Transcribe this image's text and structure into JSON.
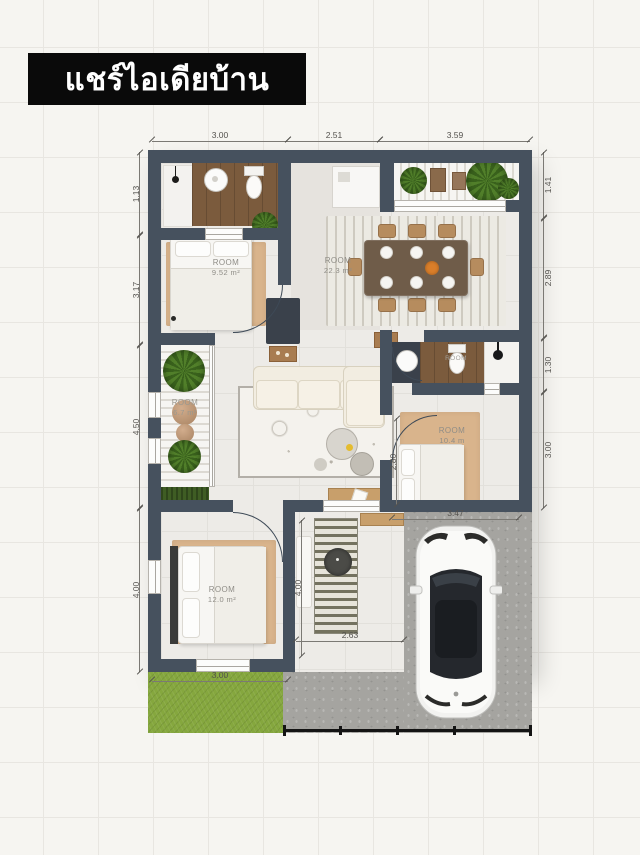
{
  "title": "แชร์ไอเดียบ้าน",
  "plan": {
    "dims": {
      "top": [
        "3.00",
        "2.51",
        "3.59"
      ],
      "left": [
        "1.13",
        "3.17",
        "4.50",
        "4.00"
      ],
      "right": [
        "1.41",
        "2.89",
        "1.30",
        "3.00"
      ],
      "inner": {
        "bedroom_right_width": "2.80",
        "bedroom_right_length": "3.47",
        "closet_height": "4.00",
        "closet_width": "2.63",
        "bedroom_bottom_width": "3.00"
      }
    },
    "rooms": {
      "bedroom_top_left": {
        "label": "ROOM",
        "area": "9.52 m²"
      },
      "dining": {
        "label": "ROOM",
        "area": "22.3 m²"
      },
      "garden_strip": {
        "label": "ROOM",
        "area": "6.7 m²"
      },
      "bathroom_right": {
        "label": "ROOM",
        "area": ""
      },
      "bedroom_right": {
        "label": "ROOM",
        "area": "10.4 m"
      },
      "bedroom_bottom_left": {
        "label": "ROOM",
        "area": "12.0 m²"
      }
    }
  },
  "colors": {
    "wall": "#46515e",
    "rug_tan": "#d9b48c",
    "wood": "#7b5b3d",
    "grass": "#85a73e",
    "concrete": "#a5a4a0",
    "plant_green": "#4a7a26",
    "banner_bg": "#0a0a0a",
    "banner_text": "#ffffff"
  }
}
